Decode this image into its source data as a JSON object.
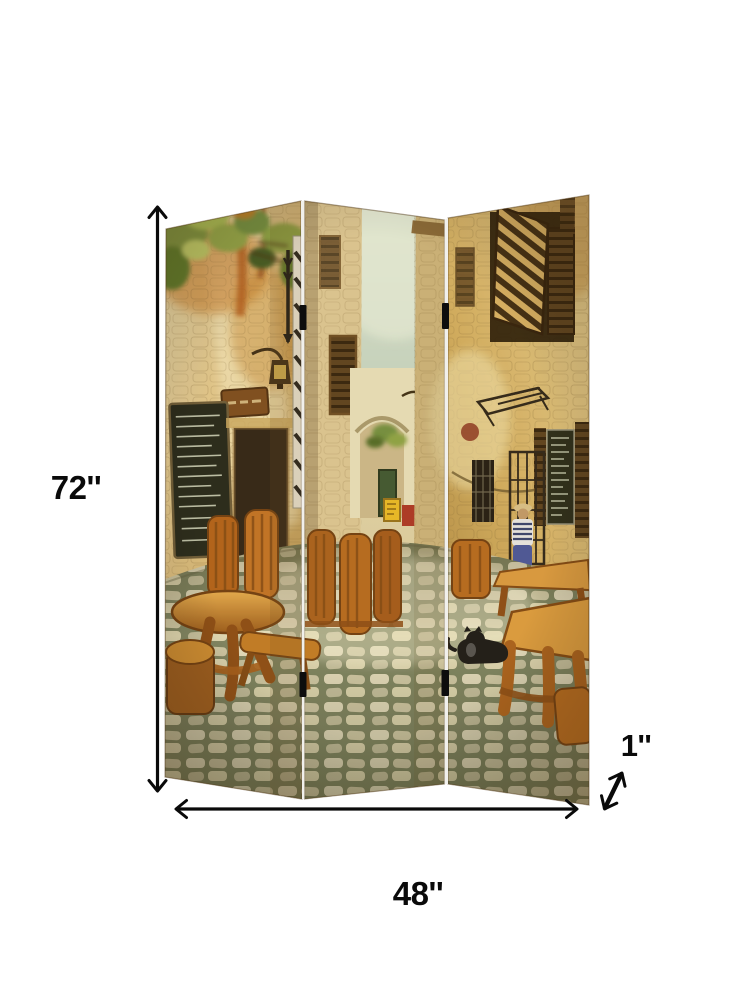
{
  "product": {
    "name": "3 Panel Room Divider Screen",
    "panel_count": 3,
    "artwork_alt": "Vintage old-town street cafe scene: stone buildings with hanging vines, chalkboard menus, shuttered windows, rustic wooden tables and chairs on a cobblestone lane, a black cat"
  },
  "annotations": {
    "height": {
      "label": "72''",
      "value": 72,
      "unit": "inches",
      "orientation": "vertical"
    },
    "width": {
      "label": "48''",
      "value": 48,
      "unit": "inches",
      "orientation": "horizontal"
    },
    "depth": {
      "label": "1''",
      "value": 1,
      "unit": "inches",
      "orientation": "diagonal"
    }
  },
  "colors": {
    "background": "#ffffff",
    "annotation": "#0a0a0a",
    "stone_light": "#ecdfae",
    "stone_warm": "#c89a4e",
    "wood": "#b5691e",
    "foliage_green": "#7d9440",
    "cobblestone": "#8a9070",
    "sky_haze": "#cfdfd2",
    "hinge": "#0d0d0d"
  }
}
